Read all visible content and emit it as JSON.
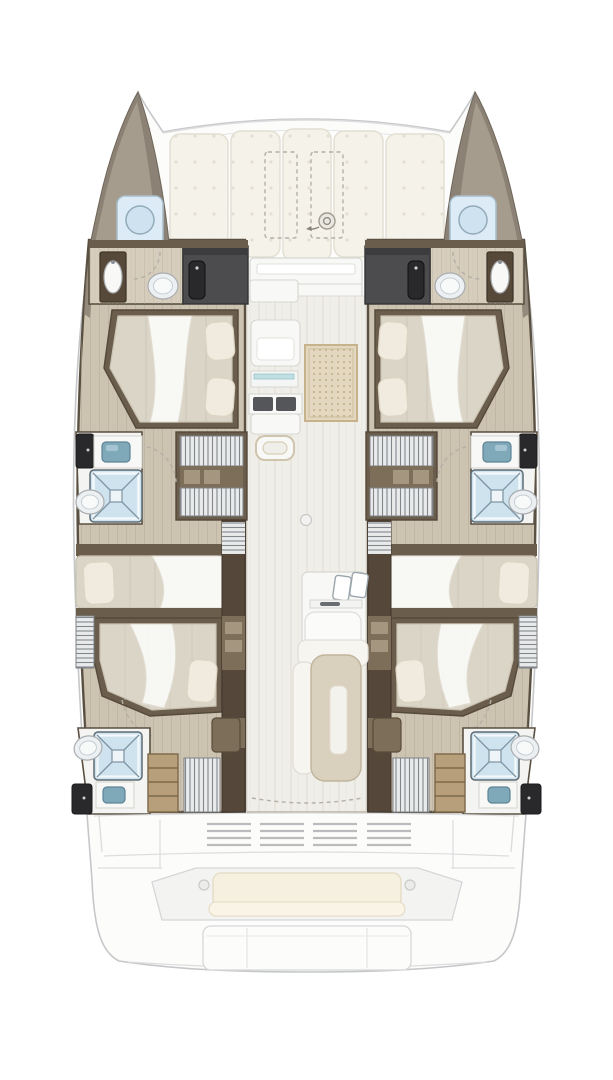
{
  "title": "Catamaran yacht floor plan, top-down view, bow at top",
  "palette": {
    "deck": "#fcfcfb",
    "outline": "#c5c7c9",
    "deck_line": "#dcddde",
    "bow_dark": "#8b8174",
    "bow_light": "#a69c8e",
    "wood": "#cdc3b1",
    "wood_line": "#b7ab96",
    "wall_line": "#5a5042",
    "brown": "#6b5d4b",
    "brown_dark": "#55483a",
    "brown_mid": "#7d6e5a",
    "charcoal": "#4c4c4e",
    "door_black": "#29292b",
    "mattress": "#dbd5c8",
    "mattress_line": "#c9c2b2",
    "pillow": "#f1ebdf",
    "pillow_line": "#dcd4c2",
    "duvet": "#fbfbf9",
    "fixture_white": "#f8f8f6",
    "fixture_line": "#d6d6d2",
    "counter_dark": "#55565a",
    "shower_pod": "#dcebf5",
    "shower_blue": "#cfe3ef",
    "shower_line": "#7d93a2",
    "porcelain_line": "#a9adb0",
    "sink_teal": "#7fa8b9",
    "sink_teal_line": "#5d8496",
    "steps_light": "#e9eaeb",
    "slat_line": "#83878b",
    "step_wood": "#b89f7c",
    "step_wood_line": "#7c6848",
    "rug": "#e3d7bf",
    "rug_border": "#c6b38b",
    "rug_dot": "#bfae88",
    "cushion": "#f5f2ea",
    "cushion_line": "#e2ded2",
    "cushion_dot": "#e3dfd2",
    "bench_cushion": "#f6f0e0",
    "bench_cushion_line": "#e3dac2",
    "corridor": "#f0eee8",
    "corridor_streak": "#e6e3da",
    "table": "#d9d0bd",
    "table_line": "#bfb49c",
    "table_slot": "#f4f2ec",
    "dash_line": "#b3b0a6"
  },
  "vessel": {
    "view": "overhead interior layout",
    "orientation": "bow-up",
    "foredeck": {
      "features": [
        "forward sunpad with five button-tufted cushions",
        "two dashed deck hatches",
        "windlass",
        "forward console"
      ]
    },
    "port_hull": {
      "rooms": [
        {
          "name": "bow locker",
          "features": [
            "shower pod with porthole"
          ]
        },
        {
          "name": "forward bathroom",
          "features": [
            "washbasin unit",
            "toilet"
          ]
        },
        {
          "name": "forward wardrobe",
          "features": [
            "charcoal locker with black door"
          ]
        },
        {
          "name": "forward cabin",
          "features": [
            "island double bed",
            "two pillows",
            "white duvet"
          ]
        },
        {
          "name": "mid bathroom",
          "features": [
            "black door",
            "teal washbasin",
            "shower with X floor",
            "toilet"
          ]
        },
        {
          "name": "companionway",
          "features": [
            "louvered steps",
            "storage shelf"
          ]
        },
        {
          "name": "mid cabin",
          "features": [
            "athwartships double bed",
            "pillow outboard"
          ]
        },
        {
          "name": "aft cabin",
          "features": [
            "athwartships double bed",
            "pillow inboard",
            "louvered side locker"
          ]
        },
        {
          "name": "aft bathroom",
          "features": [
            "shower with X floor",
            "toilet",
            "teal washbasin",
            "black door"
          ]
        },
        {
          "name": "aft companionway",
          "features": [
            "wood steps",
            "louvered hatch",
            "brown locker"
          ]
        }
      ]
    },
    "starboard_hull": {
      "mirror_of": "port_hull"
    },
    "saloon": {
      "rooms": [
        {
          "name": "galley port side",
          "features": [
            "cabinets",
            "glass cooktop strip",
            "counter with dark insets",
            "drawer unit",
            "hatch handle"
          ]
        },
        {
          "name": "saloon floor",
          "features": [
            "dotted rug",
            "ceiling light dot",
            "sliding-door dashed fold line"
          ]
        },
        {
          "name": "galley island",
          "features": [
            "double sink",
            "faucet",
            "rounded front cabinet"
          ]
        },
        {
          "name": "dinette",
          "features": [
            "L-bench",
            "rectangular table with inset tray"
          ]
        }
      ]
    },
    "cockpit": {
      "features": [
        "four engine vent grilles",
        "aft bench with cream cushion",
        "two grab rings",
        "swim platform with seams",
        "deck seam lines"
      ]
    }
  }
}
